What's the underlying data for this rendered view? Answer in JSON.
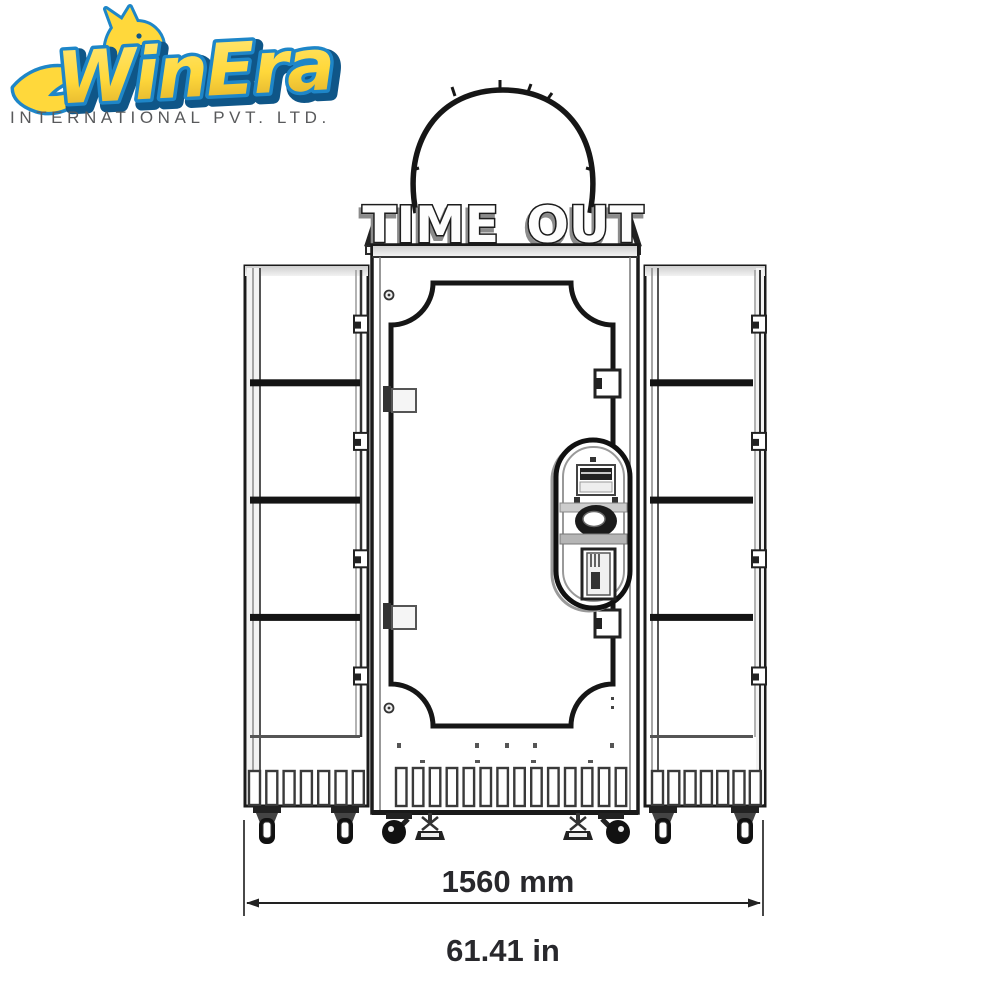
{
  "logo": {
    "brand": "WinEra",
    "subtitle": "INTERNATIONAL PVT. LTD.",
    "colors": {
      "gold": "#FFD83B",
      "gold_light": "#FFE87A",
      "gold_dark": "#D9A92A",
      "blue": "#1E86C8",
      "blue_dark": "#0F5688",
      "subtitle_gray": "#58595b"
    }
  },
  "drawing": {
    "marquee_text": "TIME OUT",
    "dimension": {
      "mm": "1560 mm",
      "inches": "61.41 in"
    },
    "left_cabinet": {
      "compartments": 4,
      "vent_slots": 7
    },
    "right_cabinet": {
      "compartments": 4,
      "vent_slots": 7
    },
    "center_unit": {
      "vent_slots": 14,
      "panel_items": [
        "bill-acceptor",
        "coin-entry",
        "coin-return"
      ]
    },
    "casters": {
      "swivel_side": 4,
      "swivel_black": 2,
      "leveling_feet": 2
    },
    "line_color": "#1a1a1a",
    "text_color": "#28282c"
  }
}
